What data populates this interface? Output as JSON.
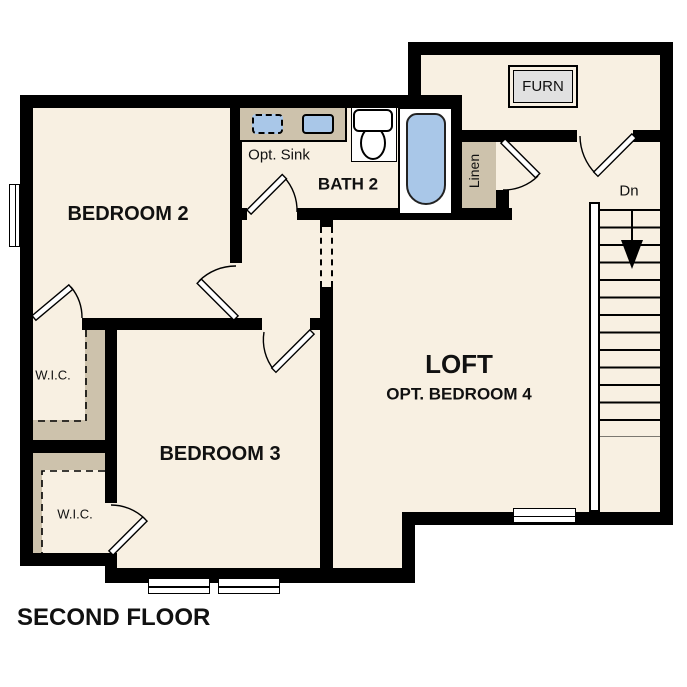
{
  "plan_title": "SECOND FLOOR",
  "colors": {
    "floor_cream": "#f8f0e2",
    "closet_tan": "#cdc2ac",
    "fixture_blue": "#a9c7e8",
    "wall_black": "#000000",
    "furnace_gray": "#e1e1e1",
    "background": "#ffffff"
  },
  "rooms": {
    "bedroom2": {
      "label": "BEDROOM 2"
    },
    "bedroom3": {
      "label": "BEDROOM 3"
    },
    "bath2": {
      "label": "BATH 2",
      "opt_sink": "Opt. Sink"
    },
    "loft": {
      "label": "LOFT",
      "sublabel": "OPT. BEDROOM 4"
    },
    "wic1": {
      "label": "W.I.C."
    },
    "wic2": {
      "label": "W.I.C."
    },
    "linen": {
      "label": "Linen"
    },
    "furnace": {
      "label": "FURN"
    },
    "stairs": {
      "direction_label": "Dn"
    }
  }
}
